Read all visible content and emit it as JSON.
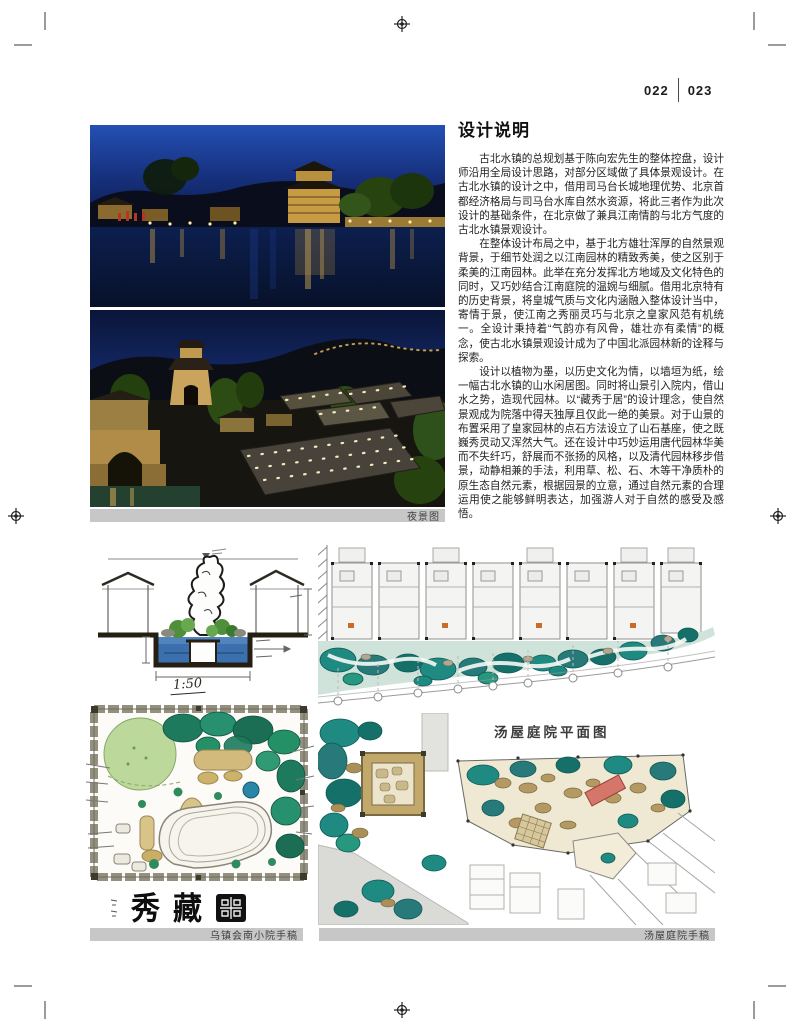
{
  "page": {
    "page_number_left": "022",
    "page_number_right": "023"
  },
  "article": {
    "title": "设计说明",
    "paragraphs": [
      "古北水镇的总规划基于陈向宏先生的整体控盘，设计师沿用全局设计思路，对部分区域做了具体景观设计。在古北水镇的设计之中，借用司马台长城地理优势、北京首都经济格局与司马台水库自然水资源，将此三者作为此次设计的基础条件，在北京做了兼具江南情韵与北方气度的古北水镇景观设计。",
      "在整体设计布局之中，基于北方雄壮浑厚的自然景观背景，于细节处润之以江南园林的精致秀美，使之区别于柔美的江南园林。此举在充分发挥北方地域及文化特色的同时，又巧妙结合江南庭院的温婉与细腻。借用北京特有的历史背景，将皇城气质与文化内涵融入整体设计当中，寄情于景，使江南之秀丽灵巧与北京之皇家风范有机统一。全设计秉持着“气韵亦有风骨，雄壮亦有柔情”的概念，使古北水镇景观设计成为了中国北派园林新的诠释与探索。",
      "设计以植物为墨，以历史文化为情，以墙垣为纸，绘一幅古北水镇的山水闲居图。同时将山景引入院内，借山水之势，造现代园林。以“藏秀于居”的设计理念，使自然景观成为院落中得天独厚且仅此一绝的美景。对于山景的布置采用了皇家园林的点石方法设立了山石基座，使之既巍秀灵动又浑然大气。还在设计中巧妙运用唐代园林华美而不失纤巧，舒展而不张扬的风格，以及清代园林移步借景，动静相兼的手法，利用草、松、石、木等干净质朴的原生态自然元素，根据园景的立意，通过自然元素的合理运用使之能够鲜明表达，加强游人对于自然的感受及感悟。"
    ]
  },
  "photos": {
    "caption": "夜景图"
  },
  "sketches": {
    "section_scale": "1:50",
    "calligraphy_char_1": "秀",
    "calligraphy_char_2": "藏",
    "tang_plan_title": "汤屋庭院平面图",
    "left_caption": "乌镇会南小院手稿",
    "right_caption": "汤屋庭院手稿"
  },
  "colors": {
    "caption_bar_bg": "#c7c7c7",
    "night_sky_blue": "#1d3f9e",
    "landscape_teal": "#1f8a82",
    "rock_tan": "#c2a96b",
    "accent_red": "#d4766a"
  }
}
